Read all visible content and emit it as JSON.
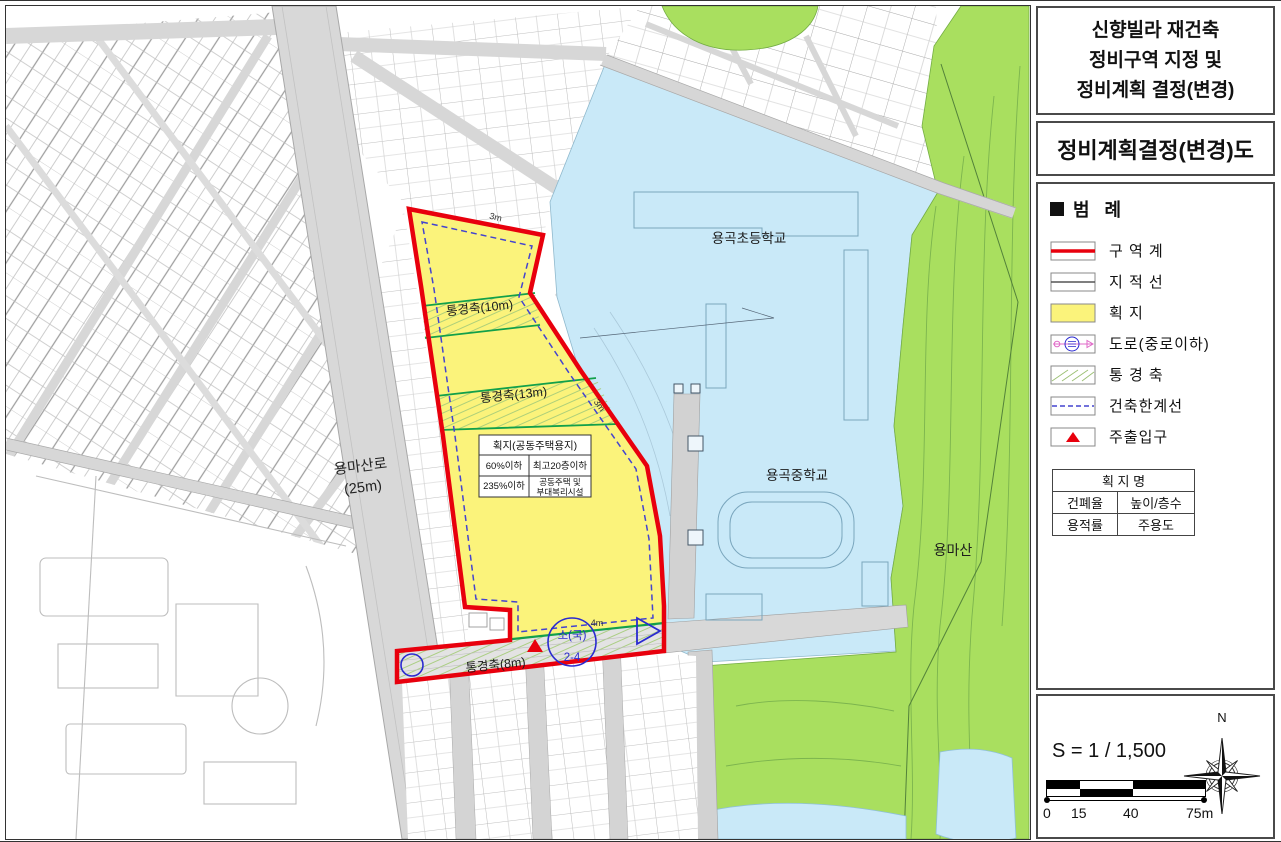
{
  "right_panel": {
    "title_lines": [
      "신향빌라 재건축",
      "정비구역 지정 및",
      "정비계획 결정(변경)"
    ],
    "subtitle": "정비계획결정(변경)도",
    "legend": {
      "title": "범 례",
      "items": [
        {
          "name": "zone-boundary",
          "label": "구 역 계"
        },
        {
          "name": "cadastral-line",
          "label": "지 적 선"
        },
        {
          "name": "parcel",
          "label": "획 지"
        },
        {
          "name": "road-minor",
          "label": "도로(중로이하)"
        },
        {
          "name": "view-corridor",
          "label": "통 경 축"
        },
        {
          "name": "building-limit-line",
          "label": "건축한계선"
        },
        {
          "name": "main-entrance",
          "label": "주출입구"
        }
      ]
    },
    "zone_table": {
      "header": "획 지 명",
      "r1c1": "건폐율",
      "r1c2": "높이/층수",
      "r2c1": "용적률",
      "r2c2": "주용도"
    },
    "scale": {
      "ratio": "S = 1 / 1,500",
      "tick0": "0",
      "tick1": "15",
      "tick2": "40",
      "tick3": "75m",
      "north": "N"
    }
  },
  "map": {
    "labels": {
      "elementary_school": "용곡초등학교",
      "middle_school": "용곡중학교",
      "mountain": "용마산",
      "main_road": "용마산로",
      "main_road_width": "(25m)",
      "corridor_10m": "통경축(10m)",
      "corridor_13m": "통경축(13m)",
      "corridor_8m": "통경축(8m)",
      "setback_top": "3m",
      "setback_side": "3m",
      "setback_bottom": "4m",
      "road_no_top": "소(국)",
      "road_no_bottom": "2-4"
    },
    "parcel_table": {
      "header": "획지(공동주택용지)",
      "r1c1": "60%이하",
      "r1c2": "최고20층이하",
      "r2c1": "235%이하",
      "r2c2a": "공동주택 및",
      "r2c2b": "부대복리시설"
    },
    "colors": {
      "zone_boundary": "#e8000d",
      "parcel_fill": "#fbf37b",
      "school_fill": "#c9e9f8",
      "greenery_fill": "#a9df5f",
      "road_fill": "#d8d8d8",
      "corridor_line": "#12a04a",
      "building_limit": "#4343cf",
      "road_symbol": "#2a2ad0"
    }
  }
}
